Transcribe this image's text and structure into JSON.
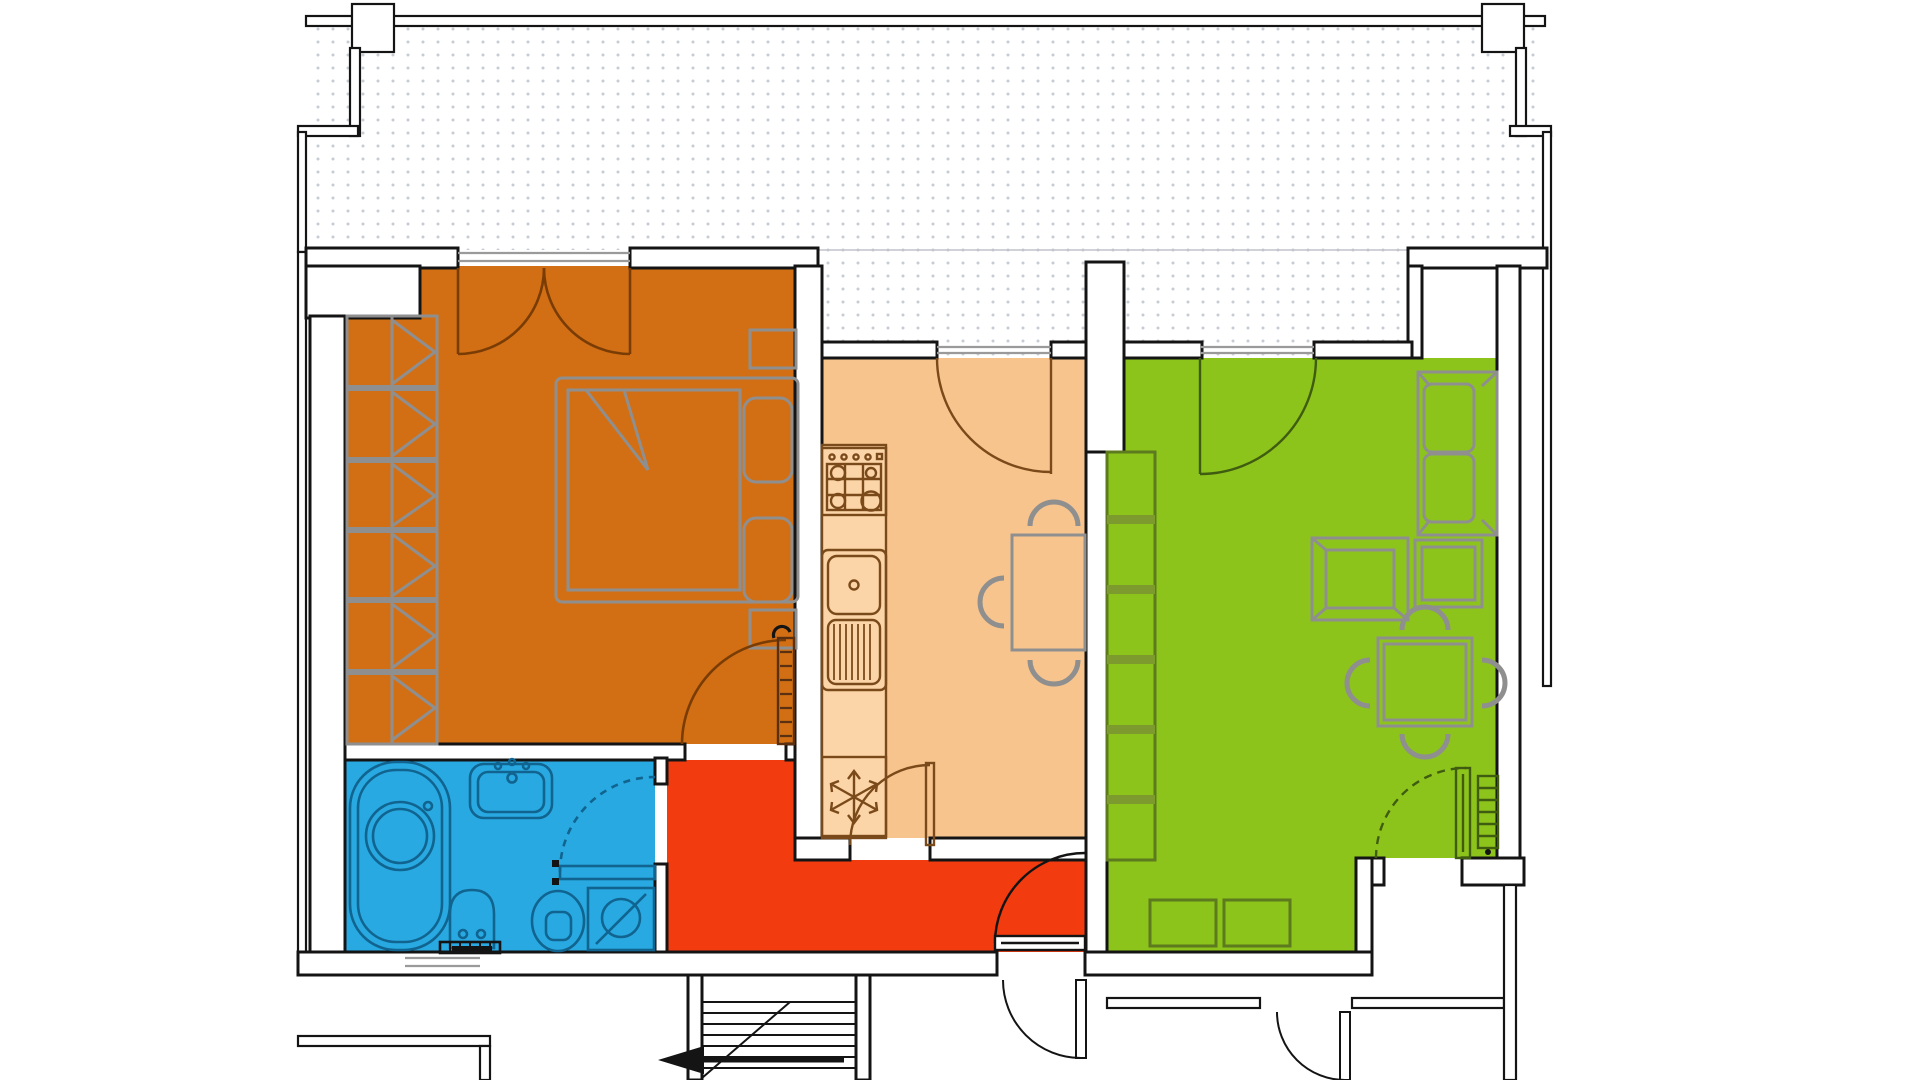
{
  "document": {
    "kind": "apartment-floor-plan",
    "canvas": {
      "width": 1920,
      "height": 1080
    },
    "visible_text": "none"
  },
  "colors": {
    "background": "#ffffff",
    "wall_line": "#141414",
    "terrace_dots": "#c7ccd4",
    "bedroom": "#d26f15",
    "kitchen": "#f8c48d",
    "living_room": "#8cc41c",
    "bathroom": "#29a9e1",
    "hallway": "#f23b0f",
    "bedroom_door_line": "#7a3c05",
    "kitchen_counter_line": "#7b4a1a",
    "living_line": "#3f5c10",
    "bookshelf_bar": "#7d9a2f",
    "bath_fixture_line": "#10648f",
    "furniture_gray": "#8f8f8f"
  },
  "rooms": [
    {
      "id": "terrace",
      "name": "terrace-balcony",
      "pattern": "dot-grid"
    },
    {
      "id": "bedroom",
      "name": "bedroom"
    },
    {
      "id": "kitchen",
      "name": "kitchen"
    },
    {
      "id": "living_room",
      "name": "living-room"
    },
    {
      "id": "bathroom",
      "name": "bathroom"
    },
    {
      "id": "hallway",
      "name": "entrance-hall"
    }
  ],
  "fixtures": {
    "bedroom": [
      "wardrobe-with-hangers",
      "double-bed",
      "pillows",
      "nightstand-upper",
      "nightstand-lower",
      "balcony-french-double-door",
      "room-door-with-panel-leaf"
    ],
    "kitchen": [
      "gas-stove-4-burners",
      "worktop",
      "sink-with-drainer",
      "refrigerator-snowflake",
      "dining-table",
      "three-chairs",
      "balcony-door",
      "hall-door"
    ],
    "living_room": [
      "bookshelf",
      "sofa-two-seat",
      "armchair",
      "coffee-table",
      "square-table-with-four-chairs",
      "two-stools",
      "radiator",
      "balcony-door",
      "exit-door-dashed-swing"
    ],
    "bathroom": [
      "corner-bathtub",
      "washbasin",
      "bidet",
      "toilet",
      "washing-machine",
      "radiator",
      "door-dashed-swing"
    ],
    "hallway": [
      "entrance-door"
    ],
    "outside": [
      "staircase-with-arrow",
      "landing-door-left",
      "landing-door-right",
      "window-below-bathroom"
    ]
  }
}
